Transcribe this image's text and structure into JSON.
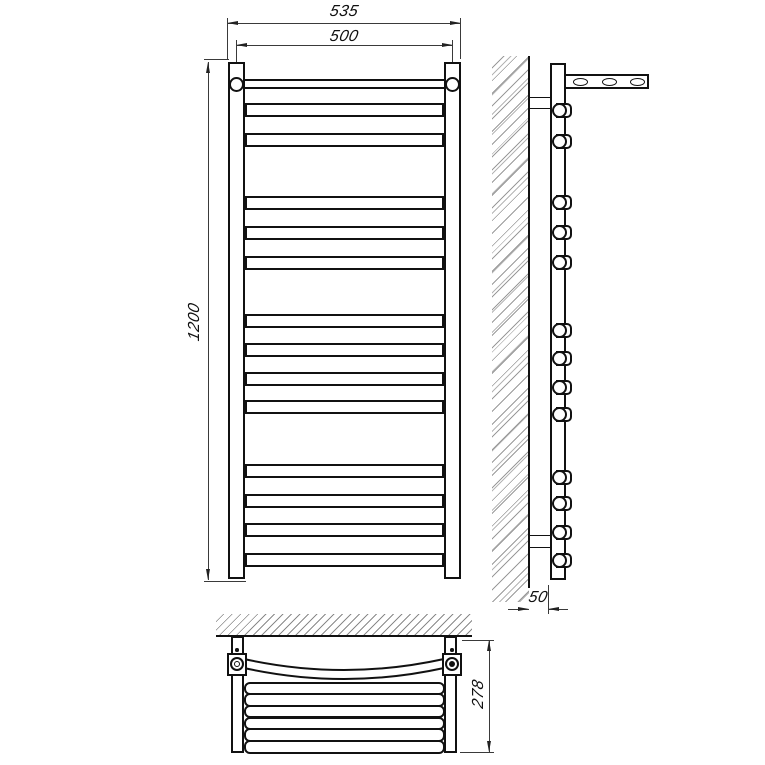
{
  "drawing_title": "heated-towel-rail-three-view-technical-drawing",
  "dimensions": {
    "overall_width": "535",
    "rail_center_width": "500",
    "height": "1200",
    "wall_offset": "50",
    "depth": "278"
  },
  "diagram": {
    "front_view": {
      "rung_tube_tops": [
        103,
        133,
        196,
        226,
        256,
        314,
        343,
        371.5,
        400,
        464,
        493.5,
        523,
        552.5
      ],
      "rung_groups": [
        2,
        3,
        4,
        4
      ],
      "top_rung_with_mount_rings": true
    },
    "side_view": {
      "cylinder_centers_y": [
        110.5,
        141.5,
        202.5,
        232.5,
        262.5,
        330,
        358.5,
        387.5,
        414.5,
        477,
        503.5,
        532.5,
        560
      ],
      "arm_hole_centers_x": [
        580.7,
        609,
        637.3
      ]
    },
    "bottom_view": {
      "flat_bar_tops": [
        681.5,
        693.2,
        704.9,
        716.6,
        728.3,
        740
      ],
      "curved_rung": true
    }
  }
}
